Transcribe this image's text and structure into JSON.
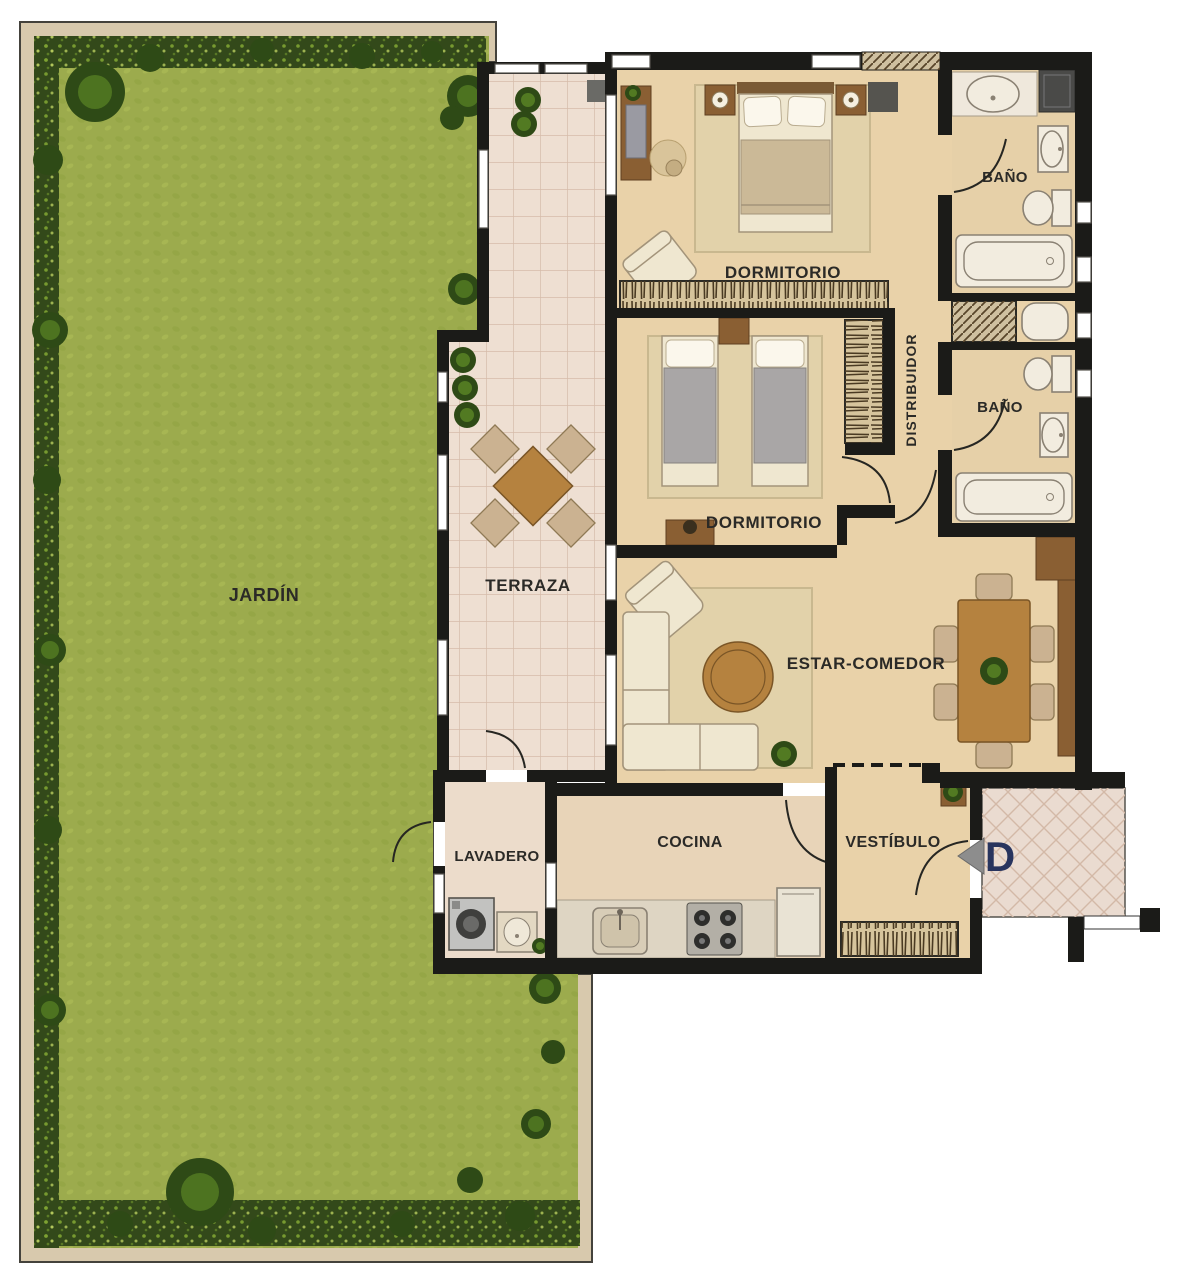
{
  "plan": {
    "type": "apartment-floor-plan",
    "rooms": {
      "jardin": {
        "label": "JARDÍN"
      },
      "terraza": {
        "label": "TERRAZA"
      },
      "dormitorio_principal": {
        "label": "DORMITORIO"
      },
      "dormitorio_secundario": {
        "label": "DORMITORIO"
      },
      "bano_1": {
        "label": "BAÑO"
      },
      "bano_2": {
        "label": "BAÑO"
      },
      "distribuidor": {
        "label": "DISTRIBUIDOR"
      },
      "estar_comedor": {
        "label": "ESTAR-COMEDOR"
      },
      "lavadero": {
        "label": "LAVADERO"
      },
      "cocina": {
        "label": "COCINA"
      },
      "vestibulo": {
        "label": "VESTÍBULO"
      }
    },
    "entrance": {
      "label": "D",
      "arrow_direction": "left"
    },
    "colors": {
      "grass": "#9cab4d",
      "hedge": "#33491a",
      "garden_border": "#d8c9ad",
      "terrace_tile": "#eedfd2",
      "wood_floor": "#e9d2a9",
      "bath_floor": "#e6d0a8",
      "kitchen_floor": "#e8d4b8",
      "laundry_floor": "#ecdccb",
      "landing_tile": "#eadbd0",
      "wall": "#1b1b18",
      "furniture_wood": "#b5823f",
      "entrance_letter": "#28345e",
      "arrow_gray": "#8d8d8d"
    }
  }
}
